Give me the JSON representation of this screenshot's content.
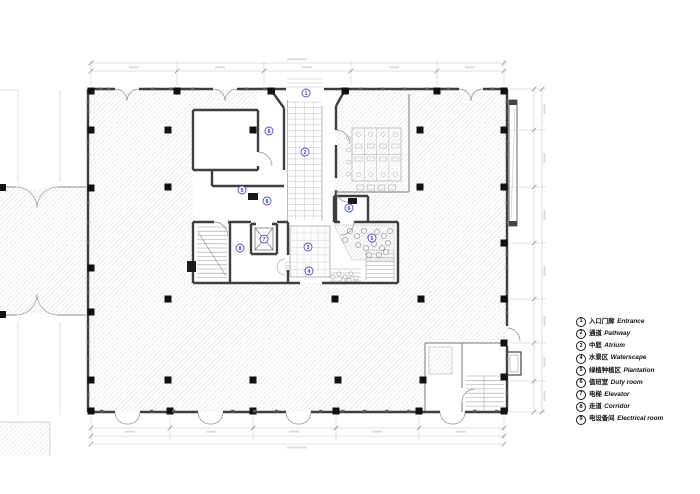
{
  "legend": {
    "items": [
      {
        "num": "1",
        "zh": "入口门廊",
        "en": "Entrance"
      },
      {
        "num": "2",
        "zh": "通道",
        "en": "Pathway"
      },
      {
        "num": "3",
        "zh": "中庭",
        "en": "Atrium"
      },
      {
        "num": "4",
        "zh": "水景区",
        "en": "Waterscape"
      },
      {
        "num": "5",
        "zh": "绿植种植区",
        "en": "Plantation"
      },
      {
        "num": "6",
        "zh": "值班室",
        "en": "Duty room"
      },
      {
        "num": "7",
        "zh": "电梯",
        "en": "Elevator"
      },
      {
        "num": "8",
        "zh": "走道",
        "en": "Corridor"
      },
      {
        "num": "9",
        "zh": "电设备间",
        "en": "Electrical room"
      }
    ]
  },
  "plan": {
    "labels": [
      {
        "num": "1"
      },
      {
        "num": "2"
      },
      {
        "num": "3"
      },
      {
        "num": "4"
      },
      {
        "num": "5"
      },
      {
        "num": "6"
      },
      {
        "num": "7"
      },
      {
        "num": "8"
      },
      {
        "num": "8"
      },
      {
        "num": "8"
      },
      {
        "num": "9"
      }
    ],
    "colors": {
      "wall": "#3e3e3e",
      "hatch": "#d7d7d7",
      "label_blue": "#4d4dbb",
      "column": "#111111"
    }
  }
}
